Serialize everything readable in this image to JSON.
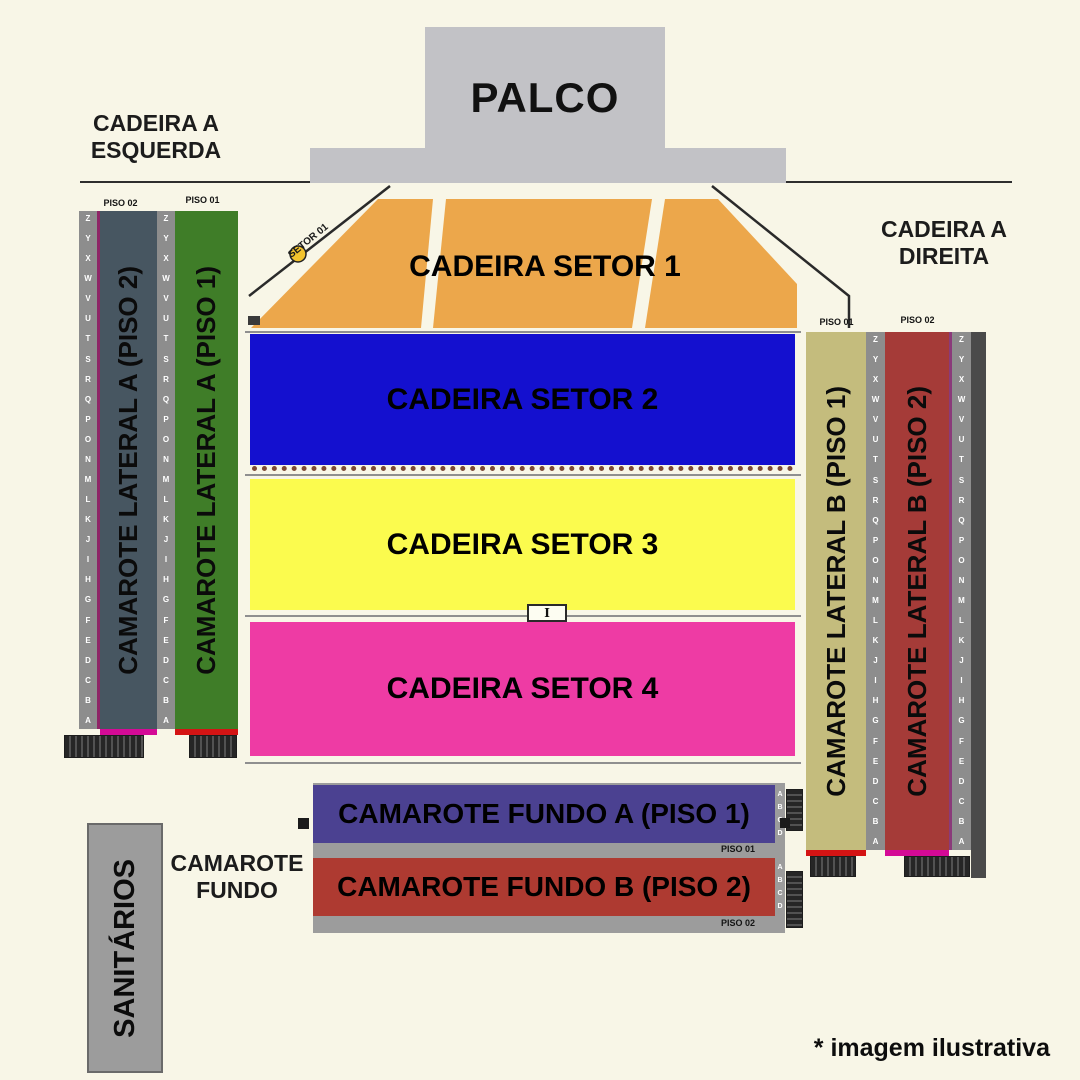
{
  "stage": {
    "label": "PALCO"
  },
  "labels": {
    "left_area": [
      "CADEIRA A",
      "ESQUERDA"
    ],
    "right_area": [
      "CADEIRA A",
      "DIREITA"
    ],
    "rear_area": [
      "CAMAROTE",
      "FUNDO"
    ],
    "sanitarios": "SANITÁRIOS",
    "footnote": "* imagem ilustrativa",
    "setor01_line": "SETOR 01",
    "mixer_glyph": "I"
  },
  "sectors": {
    "s1": {
      "label": "CADEIRA SETOR 1",
      "color": "#eca74b"
    },
    "s2": {
      "label": "CADEIRA SETOR 2",
      "color": "#1410cf"
    },
    "s3": {
      "label": "CADEIRA SETOR 3",
      "color": "#fbfb4e"
    },
    "s4": {
      "label": "CADEIRA SETOR 4",
      "color": "#ee3ba4"
    }
  },
  "camarote_lateral": {
    "left": {
      "piso2_header": "PISO 02",
      "piso1_header": "PISO 01",
      "piso2_label": "CAMAROTE LATERAL A (PISO 2)",
      "piso1_label": "CAMAROTE LATERAL A (PISO 1)",
      "piso2_color": "#475661",
      "piso1_color": "#3f7d28"
    },
    "right": {
      "piso1_header": "PISO 01",
      "piso2_header": "PISO 02",
      "piso1_label": "CAMAROTE LATERAL B (PISO 1)",
      "piso2_label": "CAMAROTE LATERAL B (PISO 2)",
      "piso1_color": "#c4bc7d",
      "piso2_color": "#a53b38"
    },
    "row_letters": [
      "Z",
      "Y",
      "X",
      "W",
      "V",
      "U",
      "T",
      "S",
      "R",
      "Q",
      "P",
      "O",
      "N",
      "M",
      "L",
      "K",
      "J",
      "I",
      "H",
      "G",
      "F",
      "E",
      "D",
      "C",
      "B",
      "A"
    ]
  },
  "camarote_fundo": {
    "box_a": {
      "label": "CAMAROTE FUNDO A (PISO 1)",
      "floor": "PISO 01",
      "color": "#4b4191"
    },
    "box_b": {
      "label": "CAMAROTE FUNDO B (PISO 2)",
      "floor": "PISO 02",
      "color": "#ae3a31"
    },
    "row_letters": [
      "A",
      "B",
      "C",
      "D"
    ]
  },
  "colors": {
    "background": "#f8f6e7",
    "stage_gray": "#c2c2c6",
    "letter_strip_gray": "#8d8d8d",
    "marker_dot_yellow": "#f3c32d",
    "divider_gray": "#8f8f8f",
    "stairs_dark": "#262626",
    "magenta_strip": "#d40a96",
    "red_strip": "#d41414"
  }
}
